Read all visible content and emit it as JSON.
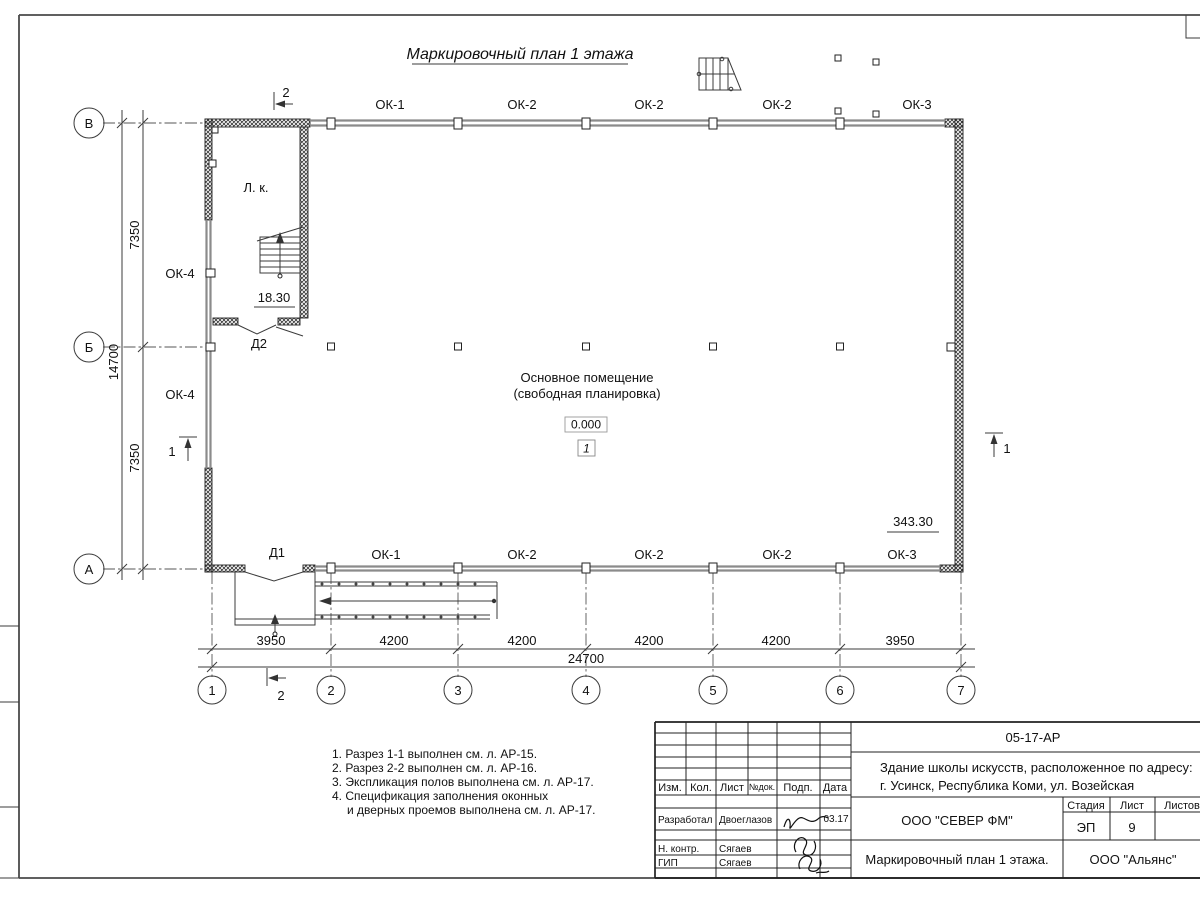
{
  "drawing_title": "Маркировочный план 1 этажа",
  "axes": {
    "rows": [
      "В",
      "Б",
      "А"
    ],
    "cols": [
      "1",
      "2",
      "3",
      "4",
      "5",
      "6",
      "7"
    ]
  },
  "dims": {
    "v_seg1": "7350",
    "v_seg2": "7350",
    "v_total": "14700",
    "h_segs": [
      "3950",
      "4200",
      "4200",
      "4200",
      "4200",
      "3950"
    ],
    "h_total": "24700"
  },
  "windows": {
    "top": [
      "ОК-1",
      "ОК-2",
      "ОК-2",
      "ОК-2",
      "ОК-3"
    ],
    "bottom": [
      "ОК-1",
      "ОК-2",
      "ОК-2",
      "ОК-2",
      "ОК-3"
    ],
    "left_upper": "ОК-4",
    "left_lower": "ОК-4"
  },
  "doors": {
    "d1": "Д1",
    "d2": "Д2"
  },
  "stair": {
    "label": "Л. к.",
    "landing_elevation": "18.30"
  },
  "room": {
    "line1": "Основное помещение",
    "line2": "(свободная планировка)",
    "level": "0.000",
    "number": "1"
  },
  "corner_elevation": "343.30",
  "section_marks": {
    "s1": "1",
    "s2": "2"
  },
  "notes": [
    "1. Разрез 1-1 выполнен см. л. АР-15.",
    "2. Разрез 2-2 выполнен см. л. АР-16.",
    "3. Экспликация полов выполнена см. л. АР-17.",
    "4. Спецификация заполнения оконных",
    "и дверных проемов выполнена см. л. АР-17."
  ],
  "titleblock": {
    "doc_code": "05-17-АР",
    "project_line1": "Здание школы искусств, расположенное по адресу:",
    "project_line2": "г. Усинск, Республика Коми, ул. Возейская",
    "company": "ООО \"СЕВЕР ФМ\"",
    "sheet_title": "Маркировочный план 1 этажа.",
    "contractor": "ООО \"Альянс\"",
    "stage_label": "Стадия",
    "stage": "ЭП",
    "sheet_label": "Лист",
    "sheet_no": "9",
    "sheets_label": "Листов",
    "cols": {
      "izm": "Изм.",
      "kol": "Кол.",
      "list": "Лист",
      "ndok": "№док.",
      "podp": "Подп.",
      "data": "Дата"
    },
    "rows": [
      {
        "role": "Разработал",
        "name": "Двоеглазов",
        "date": "03.17"
      },
      {
        "role": "Н. контр.",
        "name": "Сягаев",
        "date": ""
      },
      {
        "role": "ГИП",
        "name": "Сягаев",
        "date": ""
      }
    ]
  }
}
